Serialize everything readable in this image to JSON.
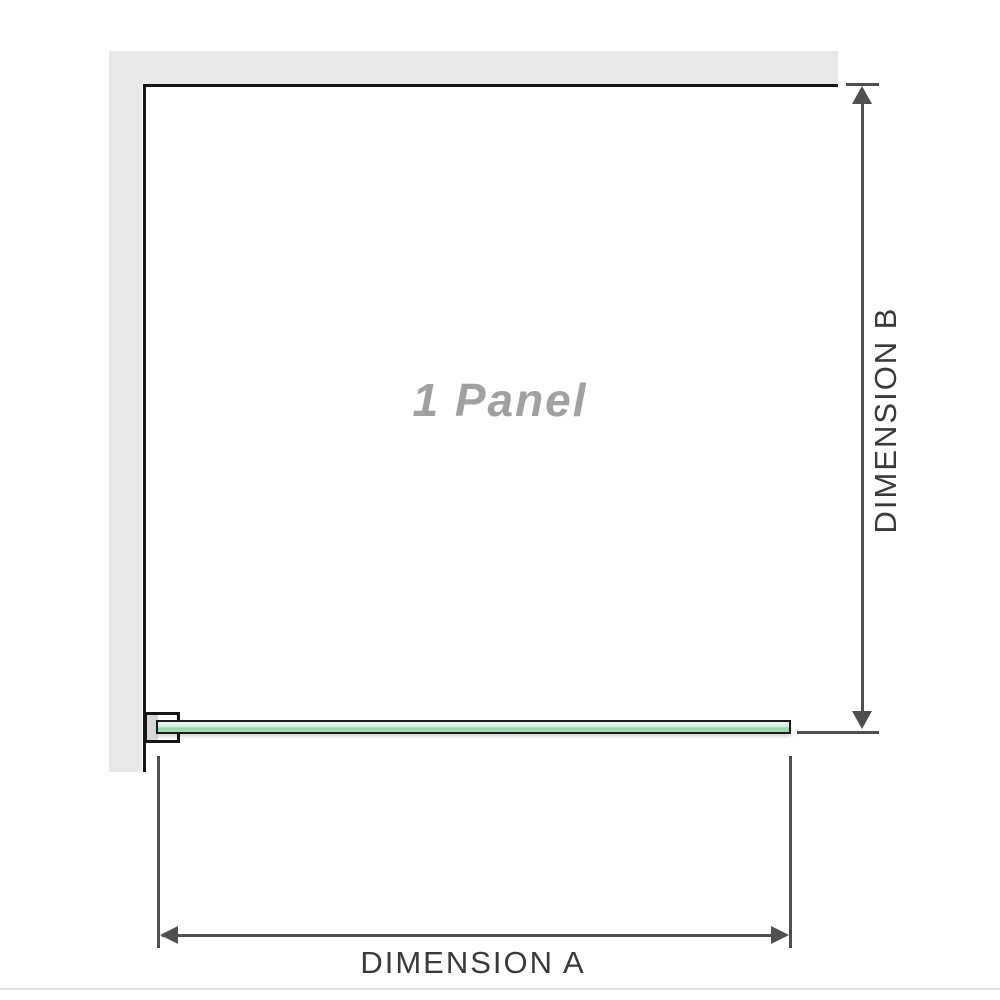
{
  "diagram": {
    "panel_label": "1 Panel",
    "dimensions": {
      "a_label": "DIMENSION A",
      "b_label": "DIMENSION B"
    }
  },
  "icons": {
    "dim_b_arrow_up": "triangle-up",
    "dim_b_arrow_down": "triangle-down",
    "dim_a_arrow_left": "triangle-left",
    "dim_a_arrow_right": "triangle-right"
  },
  "colors": {
    "wall": "#e9e9e9",
    "outline": "#151515",
    "dim-line": "#4f4f4f",
    "dim-text": "#3a3a3a",
    "panel-label": "#a1a1a3",
    "glass-light": "#e7f5ec",
    "glass-dark": "#9cd5ac",
    "bracket-fill": "#d8d8d8",
    "divider": "#e2e2e2"
  }
}
